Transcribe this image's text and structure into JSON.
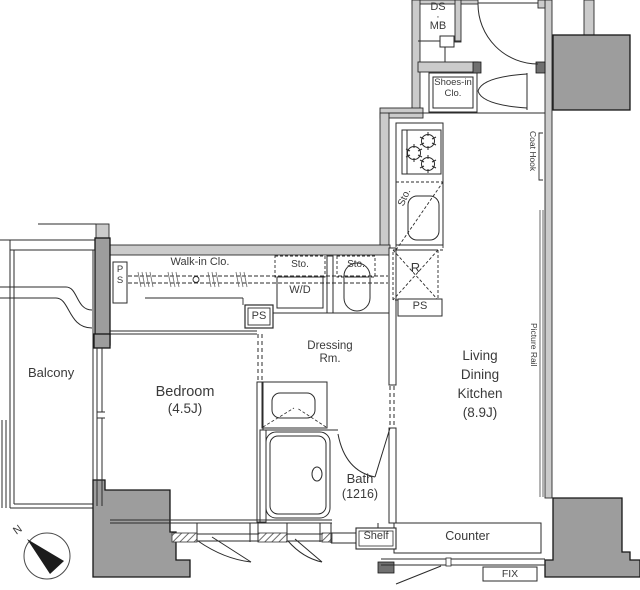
{
  "rooms": {
    "balcony": "Balcony",
    "bedroom": {
      "name": "Bedroom",
      "size": "(4.5J)"
    },
    "ldk": {
      "line1": "Living",
      "line2": "Dining",
      "line3": "Kitchen",
      "size": "(8.9J)"
    },
    "dressing": {
      "line1": "Dressing",
      "line2": "Rm."
    },
    "bath": {
      "name": "Bath",
      "size": "(1216)"
    },
    "walkin_closet": "Walk-in Clo.",
    "shoes_closet": {
      "line1": "Shoes-in",
      "line2": "Clo."
    }
  },
  "fixtures": {
    "ds": "DS",
    "mb": "MB",
    "dot": "·",
    "coat_hook": "Coat Hook",
    "picture_rail": "Picture Rail",
    "sto": "Sto.",
    "wd": "W/D",
    "refrigerator": "R",
    "ps": "PS",
    "p": "P",
    "s": "S",
    "shelf": "Shelf",
    "counter": "Counter",
    "fix": "FIX"
  },
  "compass": {
    "north": "N"
  },
  "icons": {
    "stove": "stove-burners-icon",
    "sink": "kitchen-sink-icon",
    "toilet": "toilet-icon",
    "washbasin": "washbasin-icon",
    "bathtub": "bathtub-icon",
    "compass": "north-compass-icon"
  },
  "colors": {
    "structural_wall": "#9d9d9d",
    "light_wall": "#cbcbcb",
    "line": "#2b2b2b",
    "text": "#3a3a3a",
    "background": "#ffffff"
  }
}
